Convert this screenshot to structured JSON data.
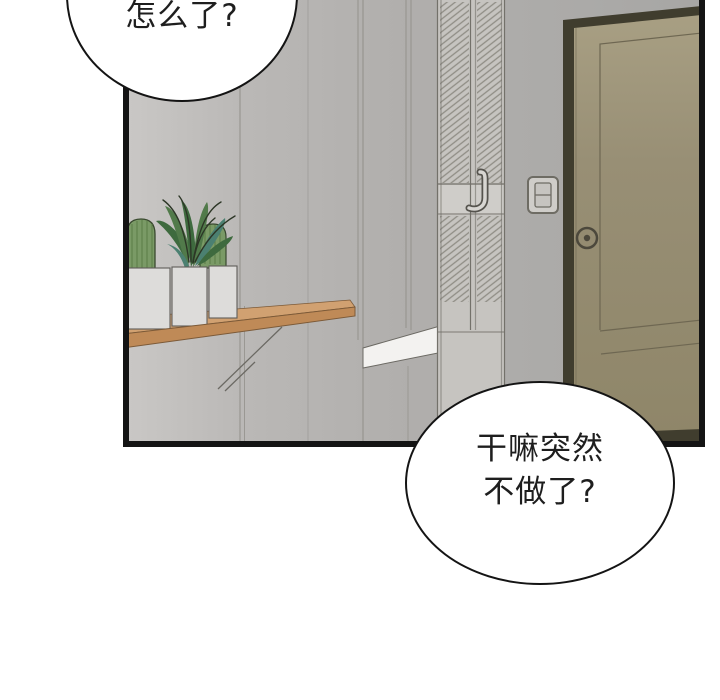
{
  "page": {
    "kind": "webtoon-comic-panel"
  },
  "bubbles": [
    {
      "name": "top-left",
      "text": "怎么了?"
    },
    {
      "name": "bottom-right",
      "lines": [
        "干嘛突然",
        "不做了?"
      ]
    }
  ],
  "scene": {
    "objects": [
      "hallway wall",
      "louvered closet door",
      "closet pull handle",
      "light switch",
      "entry door with deadbolt",
      "wall shelf",
      "shelf bracket",
      "three white planter pots",
      "barrel cactus left",
      "barrel cactus right",
      "leafy agave plant",
      "white bench surface"
    ]
  },
  "palette": {
    "ink": "#141414",
    "bubble_fill": "#ffffff",
    "wall": "#b1afad",
    "wall_light": "#c9c7c5",
    "wall_dark": "#a7a5a3",
    "wall_line": "#8d8b85",
    "louver": "#c6c4c0",
    "louver_line": "#8f8d85",
    "louver_frame": "#73716a",
    "rail": "#cfcdc9",
    "door_frame": "#403d2e",
    "door": "#948b71",
    "door_light": "#a89f83",
    "door_line": "#6e6752",
    "bolt": "#4c483c",
    "wood_top": "#d1a171",
    "wood_front": "#bf8a57",
    "wood_edge": "#7c5a38",
    "pot": "#dddcda",
    "pot_line": "#5f5d59",
    "bench": "#f3f2f0",
    "cactus": "#7a9a66",
    "cactus_dark": "#5a7c46",
    "cactus_outline": "#39492f",
    "leaf": "#517a4a",
    "leaf_dark": "#3e6a3e",
    "leaf_teal": "#4b8071",
    "leaf_spike": "#2c3626",
    "bracket": "#6b6963",
    "switch_line": "#6e6c64",
    "handle_dark": "#55534d",
    "handle_light": "#d8d6d2"
  }
}
